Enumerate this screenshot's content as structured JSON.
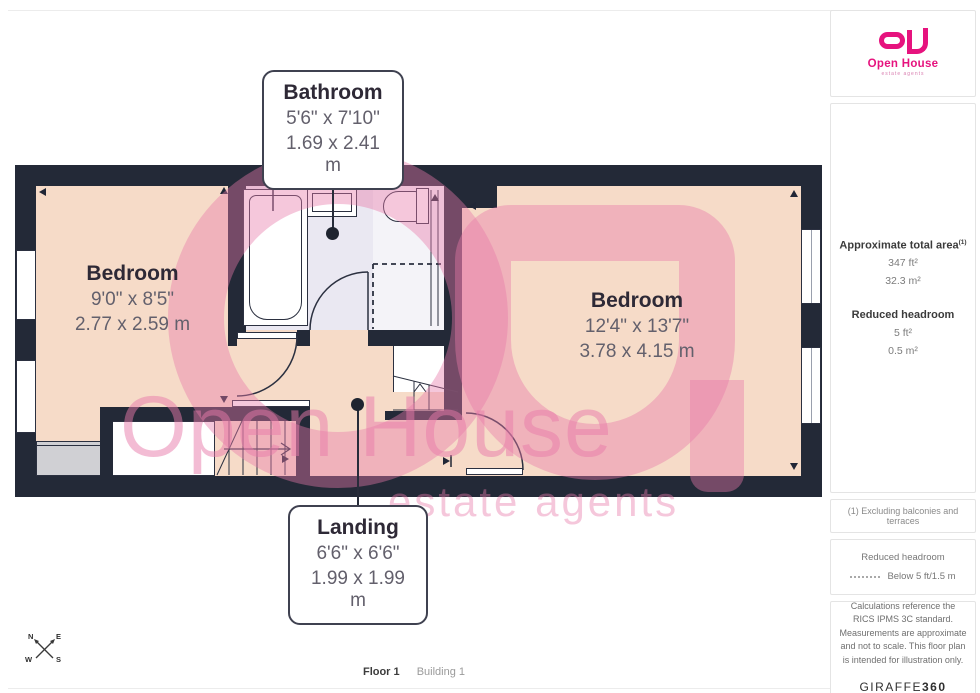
{
  "branding": {
    "logo_name": "Open House",
    "logo_tagline": "estate agents",
    "brand_color": "#e6137e"
  },
  "colors": {
    "wall": "#232937",
    "floor": "#f6dbc8",
    "bathroom_floor": "#eae8f2",
    "watermark_pink": "#e779aa",
    "label_text": "#2e2936",
    "dims_text": "#63606c"
  },
  "rooms": [
    {
      "name": "Bathroom",
      "dims_imperial": "5'6\" x 7'10\"",
      "dims_metric": "1.69 x 2.41 m"
    },
    {
      "name": "Bedroom",
      "dims_imperial": "9'0\" x 8'5\"",
      "dims_metric": "2.77 x 2.59 m"
    },
    {
      "name": "Bedroom",
      "dims_imperial": "12'4\" x 13'7\"",
      "dims_metric": "3.78 x 4.15 m"
    },
    {
      "name": "Landing",
      "dims_imperial": "6'6\" x 6'6\"",
      "dims_metric": "1.99 x 1.99 m"
    }
  ],
  "watermark": {
    "line1": "Open House",
    "line2": "estate agents"
  },
  "sidebar": {
    "area": {
      "heading": "Approximate total area",
      "sup": "(1)",
      "value_ft": "347 ft²",
      "value_m": "32.3 m²"
    },
    "reduced_headroom": {
      "heading": "Reduced headroom",
      "value_ft": "5 ft²",
      "value_m": "0.5 m²"
    },
    "note_exclusions": "(1) Excluding balconies and terraces",
    "legend": {
      "heading": "Reduced headroom",
      "value": "Below 5 ft/1.5 m"
    },
    "disclaimer": "Calculations reference the RICS IPMS 3C standard. Measurements are approximate and not to scale. This floor plan is intended for illustration only.",
    "provider": {
      "name": "GIRAFFE",
      "suffix": "360"
    }
  },
  "footer": {
    "floor": "Floor 1",
    "building": "Building 1"
  },
  "compass": {
    "n": "N",
    "e": "E",
    "s": "S",
    "w": "W"
  }
}
